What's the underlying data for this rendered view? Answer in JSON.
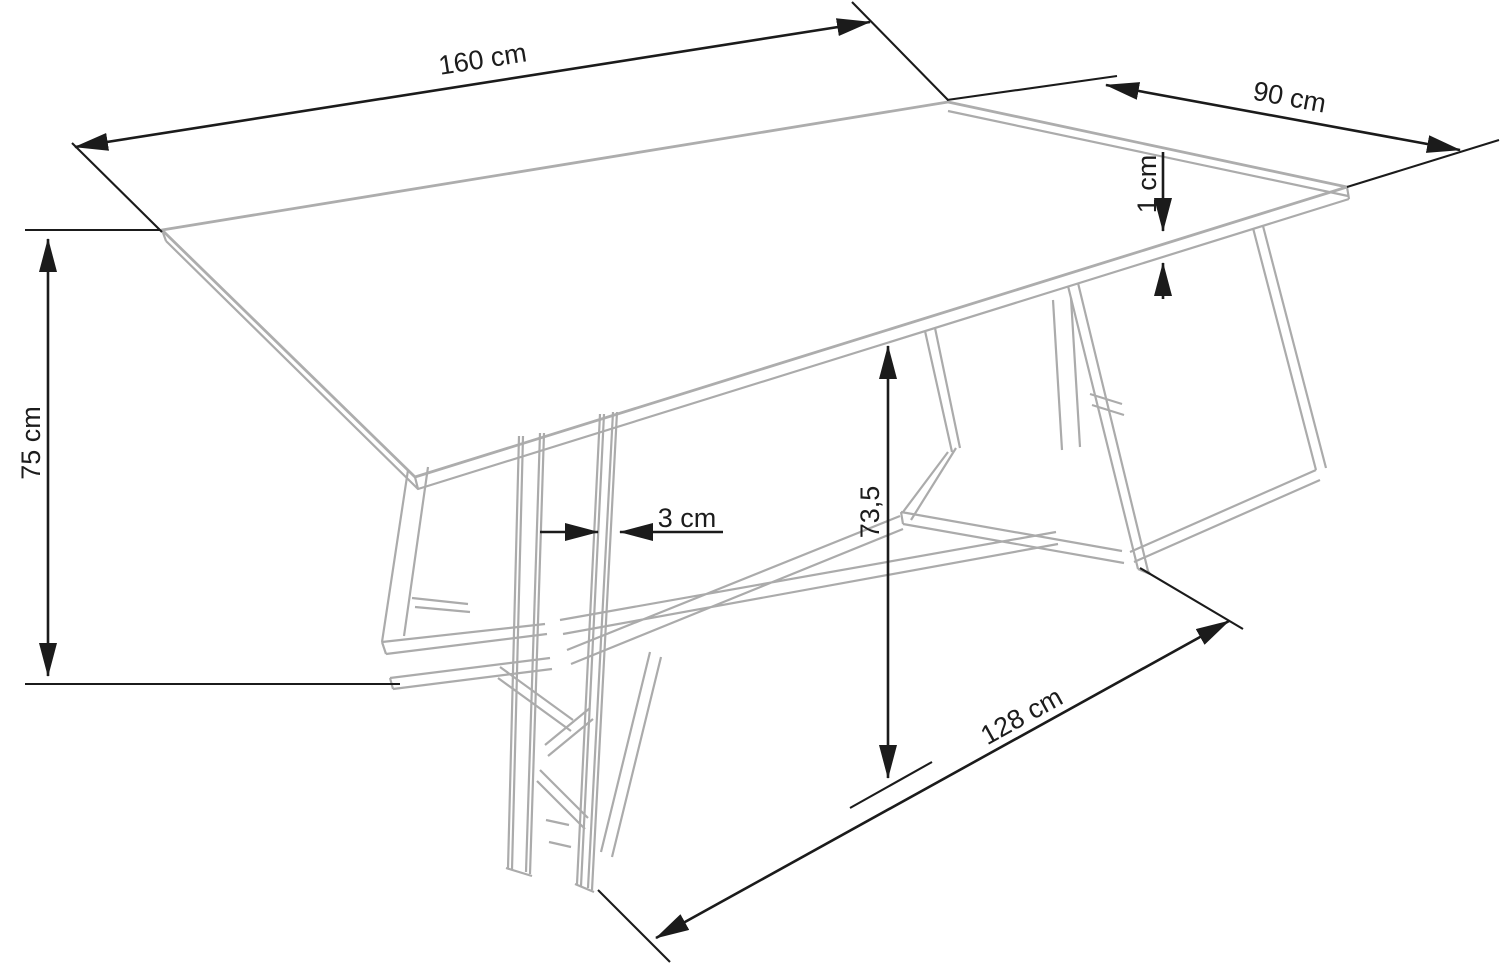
{
  "diagram": {
    "subject": "dining-table-dimension-drawing",
    "colors": {
      "background": "#ffffff",
      "dimension_lines": "#1b1b1b",
      "table_outline": "#ababab"
    },
    "dimensions": {
      "length": {
        "label": "160 cm"
      },
      "width": {
        "label": "90 cm"
      },
      "thickness": {
        "label": "1 cm"
      },
      "height": {
        "label": "75 cm"
      },
      "bar_width": {
        "label": "3 cm"
      },
      "clearance": {
        "label": "73,5"
      },
      "foot_span": {
        "label": "128 cm"
      }
    }
  }
}
